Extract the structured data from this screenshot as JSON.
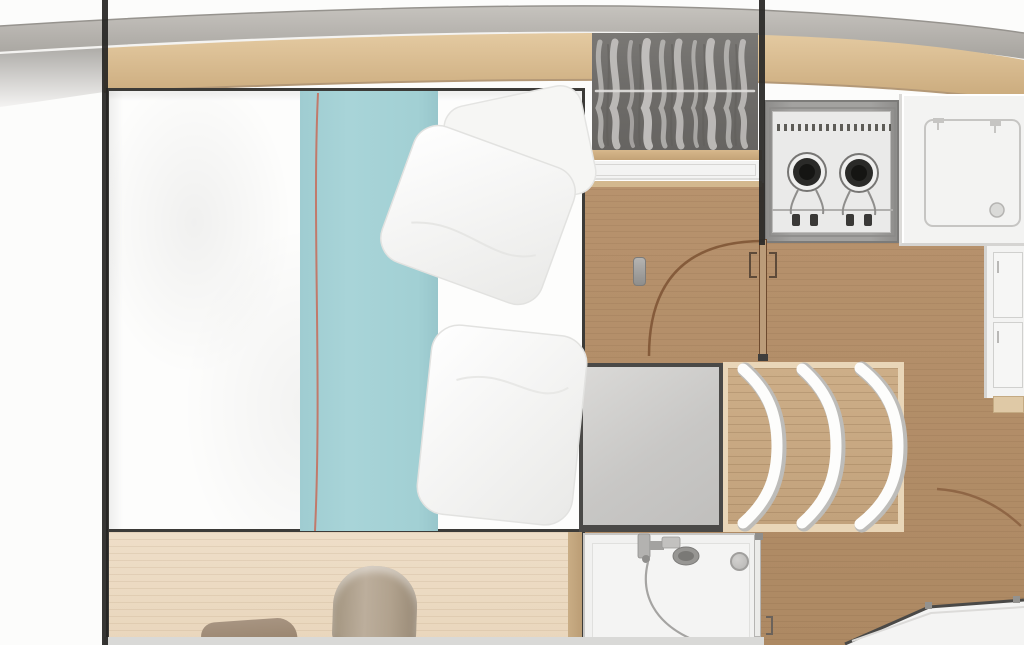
{
  "diagram": {
    "type": "floor-plan",
    "label": "Boat interior layout plan (top view): owner cabin with double berth, wardrobe, galley with two-burner stove and sink, curved companionway steps and shower compartment",
    "text_visible": "none"
  },
  "areas": {
    "hull": {
      "label": "Curved hull / deck-edge band"
    },
    "wall_left": {
      "label": "Dark bulkhead line, left side of cabin"
    },
    "wall_right": {
      "label": "Dark bulkhead line with door opening, right side"
    },
    "bed": {
      "label": "Double berth: white duvet, aqua runner with coral piping, two white pillows"
    },
    "teal_runner": {
      "label": "Aqua bed runner"
    },
    "pillows": {
      "label": "Two white pillows"
    },
    "berth_storage": {
      "label": "Lower berth section with stowed soft bags"
    },
    "duffel": {
      "label": "Rolled duffel bag"
    },
    "small_bag": {
      "label": "Small stowed bag"
    },
    "wardrobe": {
      "label": "Hanging locker with clothes on a rail (seen from above)"
    },
    "shelf": {
      "label": "Shelf front under hanging locker"
    },
    "stove": {
      "label": "Two-burner galley stove"
    },
    "counter": {
      "label": "Galley worktop with inset sink"
    },
    "cabinets": {
      "label": "Galley cabinet fronts"
    },
    "floor": {
      "label": "Wood cabin sole"
    },
    "cabin_door": {
      "label": "Cabin door with quarter-circle swing arc"
    },
    "landing": {
      "label": "Grey landing platform at foot of steps"
    },
    "steps": {
      "label": "Three curved companionway steps"
    },
    "shower": {
      "label": "Shower compartment with mixer, hand shower and round drain"
    },
    "basin": {
      "label": "Round drain / basin"
    },
    "aft_door": {
      "label": "Aft door swing arc"
    },
    "companionway": {
      "label": "Adjacent sole area behind angled threshold (bottom right)"
    },
    "reading_light": {
      "label": "Small wall fitting beside berth"
    }
  },
  "palette": {
    "bg_white": "#fcfcfb",
    "line_dark": "#262523",
    "frame_dark": "#3c3b38",
    "hull_gray": "#b7b4af",
    "hull_gray_dark": "#a6a39e",
    "wood_band": "#dcc198",
    "wood_band_dark": "#c8a678",
    "floor_wood": "#b7926d",
    "floor_wood_dark": "#ad8963",
    "step_wood": "#c2a27c",
    "step_frame": "#e9d6b8",
    "landing_gray": "#c8c7c5",
    "landing_border": "#4a4947",
    "wardrobe_gray": "#6f6d6a",
    "clothes_gray": "#c9c7c4",
    "counter_white": "#f3f3f2",
    "stove_gray": "#a3a2a0",
    "stove_unit": "#eaeae9",
    "burner_black": "#1f1f1d",
    "teal": "#a8d4d8",
    "coral": "#c4705f",
    "duvet": "#fdfdfc",
    "berth_beige": "#eedec8",
    "bag_tan": "#bcae9c",
    "bag_dark": "#97826b",
    "shower_white": "#f1f1f0",
    "fixture_gray": "#a5a4a2",
    "door_brown": "#7d5233",
    "bottom_strip": "#d9d9d7"
  }
}
